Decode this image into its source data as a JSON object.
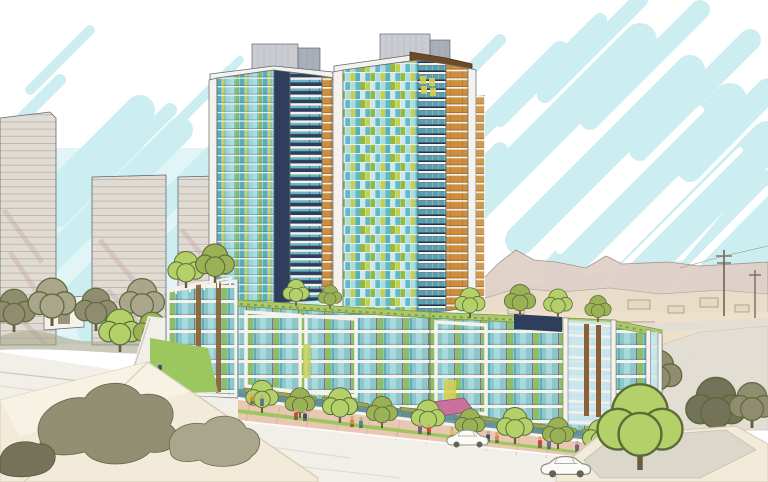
{
  "scene": {
    "description": "Hand-drawn architectural concept rendering of a two-tower residential development on a mixed-use podium, seen from above a street intersection, with sketched grey high-rises at left, distant hills and suburban sprawl at right, street trees, pedestrians and two white cars in the foreground, under a white sky with light blue marker strokes.",
    "buildings": {
      "left_tower": "glass tower with teal, green and yellow panel stripes, navy corner band, orange balcony band, white frame and grey rooftop penthouse",
      "right_tower": "taller glass tower with patchwork curtain wall, navy balcony band, orange balcony band, brown roof fascia, white frame and grey rooftop penthouse",
      "podium": "6-8 storey podium with white frames, wood fins, glass balconies, green roofs with trees, white trellis, olive retail awnings and a pink entry canopy",
      "background_left": "three sketched beige high-rise slabs with horizontal floor lines and mauve shading",
      "background_right": "low hills, suburban sprawl, wide road and utility poles"
    },
    "street": "intersection with crosswalk, pink paver sidewalks, grass boulevard strips, bright green street trees, colorful pedestrians, two sketched white cars, cream foreground rooftops with olive tree masses"
  },
  "palette": {
    "sky": "#cdeef1",
    "white": "#f4f2ea",
    "white2": "#ffffff",
    "navy": "#2f3e5c",
    "navyDeep": "#1f2c44",
    "teal": "#63b9c3",
    "tealL": "#aadde2",
    "tealD": "#57aebc",
    "pale": "#cfe8ef",
    "pod": "#8ec6ca",
    "green": "#8fba4a",
    "yel": "#c3cf52",
    "yellow": "#d8cf4a",
    "orange": "#cd8f3e",
    "orangeDk": "#8a5a2a",
    "brown": "#6e4a26",
    "wood": "#8a6038",
    "pent": "#caccd1",
    "pentD": "#a7adb6",
    "pentSeam": "#b6bac0",
    "bgb": "#e0dbd3",
    "bgline": "#b5ac9f",
    "mauve": "#c2a3ab",
    "hill": "#e0d0c8",
    "hillLine": "#a08f85",
    "ridge": "#e9dcc9",
    "sand": "#eee1cb",
    "sketch": "#9a8b7a",
    "roadFar": "#e2ded4",
    "road": "#f1efe8",
    "roadLine": "#dfdbd1",
    "walk": "#e8c8b2",
    "walkLine": "#c99f87",
    "grass": "#9cc75e",
    "treeB": "#b4d169",
    "treeM": "#9ab156",
    "treeLine": "#5d6b3a",
    "trunk": "#6b5b3e",
    "olive": "#8f8c6f",
    "oliveD": "#75725a",
    "oliveL": "#a9a68c",
    "cream": "#f2ebd9",
    "creamLine": "#d6cab2",
    "panel": "#dbd7cb",
    "retail": "#5e8b94",
    "awning": "#99a557",
    "awnLine": "#6e7a3a",
    "canopyPink": "#c9719c",
    "canopyLine": "#8d4a6e",
    "greenRoof": "#a9c96a",
    "grLine": "#7a9440",
    "outline": "#5f6977",
    "skin": "#d8a77f",
    "legs": "#4a4a50",
    "carBody": "#fbfaf6",
    "carLine": "#8e8d85",
    "wheel": "#64635b",
    "crossbar": "#ddbfa9",
    "curb": "#cfc9bc",
    "pRed": "#c84b3c",
    "pOrange": "#d98a3a",
    "pNavy": "#3a4f72",
    "pTeal": "#4e8f96",
    "pPurple": "#7c5a8a",
    "pYellow": "#d9c04a",
    "pBlue": "#5577aa"
  }
}
